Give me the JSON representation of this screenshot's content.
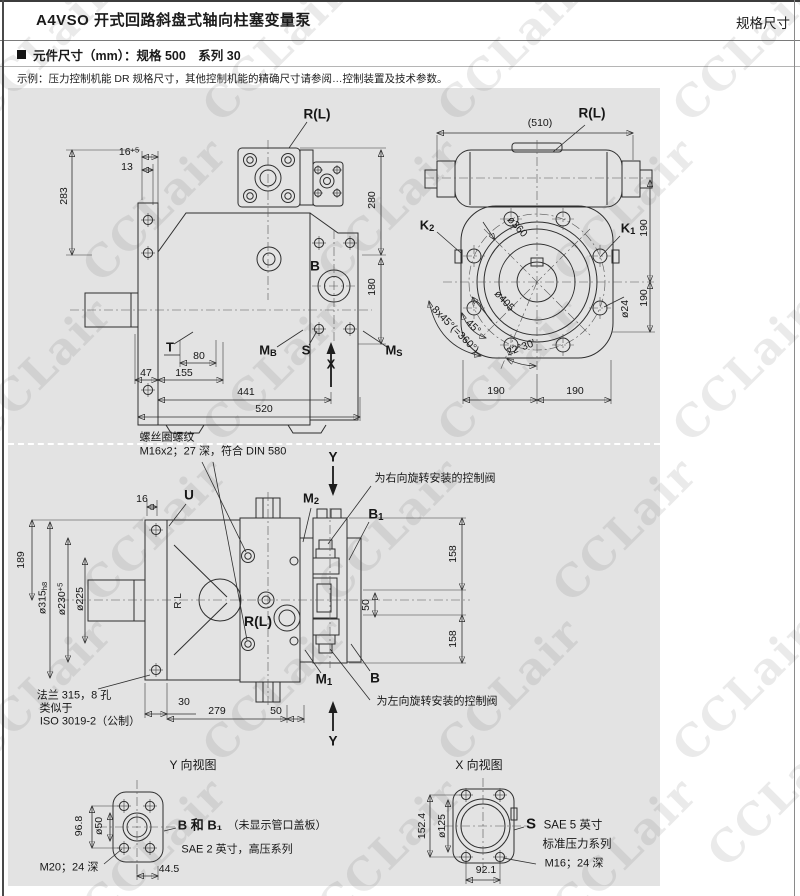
{
  "header": {
    "title": "A4VSO 开式回路斜盘式轴向柱塞变量泵",
    "page_label": "规格尺寸"
  },
  "section": {
    "bullet_title": "元件尺寸（mm）：规格 500　系列 30",
    "note": "示例：压力控制机能 DR 规格尺寸，其他控制机能的精确尺寸请参阅…控制装置及技术参数。"
  },
  "watermark": {
    "text": "CCLair",
    "tiles": [
      [
        40,
        50
      ],
      [
        275,
        50
      ],
      [
        510,
        50
      ],
      [
        745,
        50
      ],
      [
        155,
        210
      ],
      [
        390,
        210
      ],
      [
        625,
        210
      ],
      [
        40,
        370
      ],
      [
        275,
        370
      ],
      [
        510,
        370
      ],
      [
        745,
        370
      ],
      [
        155,
        530
      ],
      [
        390,
        530
      ],
      [
        625,
        530
      ],
      [
        40,
        690
      ],
      [
        275,
        690
      ],
      [
        510,
        690
      ],
      [
        745,
        690
      ],
      [
        155,
        850
      ],
      [
        390,
        850
      ],
      [
        625,
        850
      ],
      [
        780,
        795
      ]
    ]
  },
  "drawings": [
    {
      "name": "side-view-top",
      "labels": [
        {
          "n": "d1-dim-283",
          "t": "283",
          "x": 64,
          "y": 196,
          "r": -90
        },
        {
          "n": "d1-dim-16plus5",
          "t": "16",
          "sup": "+5",
          "x": 129,
          "y": 152
        },
        {
          "n": "d1-dim-13",
          "t": "13",
          "x": 127,
          "y": 167
        },
        {
          "n": "d1-port-RL",
          "t": "R(L)",
          "x": 317,
          "y": 114,
          "b": 1,
          "s": 13.5
        },
        {
          "n": "d1-dim-280",
          "t": "280",
          "x": 372,
          "y": 200,
          "r": -90
        },
        {
          "n": "d1-port-B",
          "t": "B",
          "x": 315,
          "y": 266,
          "b": 1,
          "s": 13.5
        },
        {
          "n": "d1-dim-180",
          "t": "180",
          "x": 372,
          "y": 287,
          "r": -90
        },
        {
          "n": "d1-port-T",
          "t": "T",
          "x": 170,
          "y": 347,
          "b": 1,
          "s": 13
        },
        {
          "n": "d1-dim-80",
          "t": "80",
          "x": 199,
          "y": 356
        },
        {
          "n": "d1-dim-47",
          "t": "47",
          "x": 146,
          "y": 373
        },
        {
          "n": "d1-dim-155",
          "t": "155",
          "x": 184,
          "y": 373
        },
        {
          "n": "d1-port-MB",
          "t": "M",
          "sub": "B",
          "x": 268,
          "y": 351,
          "b": 1,
          "s": 13
        },
        {
          "n": "d1-port-S",
          "t": "S",
          "x": 306,
          "y": 350,
          "b": 1,
          "s": 13
        },
        {
          "n": "d1-axis-X",
          "t": "X",
          "x": 331,
          "y": 364,
          "b": 1,
          "s": 13
        },
        {
          "n": "d1-port-MS",
          "t": "M",
          "sub": "S",
          "x": 394,
          "y": 351,
          "b": 1,
          "s": 13
        },
        {
          "n": "d1-dim-441",
          "t": "441",
          "x": 246,
          "y": 392
        },
        {
          "n": "d1-dim-520",
          "t": "520",
          "x": 264,
          "y": 409
        }
      ]
    },
    {
      "name": "flange-view-top-right",
      "labels": [
        {
          "n": "d2-dim-510",
          "t": "(510)",
          "x": 540,
          "y": 123
        },
        {
          "n": "d2-port-RL",
          "t": "R(L)",
          "x": 592,
          "y": 113,
          "b": 1,
          "s": 13.5
        },
        {
          "n": "d2-port-K2",
          "t": "K",
          "sub": "2",
          "x": 427,
          "y": 226,
          "b": 1,
          "s": 13
        },
        {
          "n": "d2-port-K1",
          "t": "K",
          "sub": "1",
          "x": 628,
          "y": 229,
          "b": 1,
          "s": 13
        },
        {
          "n": "d2-dim-190-upper",
          "t": "190",
          "x": 644,
          "y": 228,
          "r": -90
        },
        {
          "n": "d2-dim-dia360",
          "t": "ø360",
          "x": 517,
          "y": 227,
          "r": 47
        },
        {
          "n": "d2-dim-dia405",
          "t": "ø405",
          "x": 504,
          "y": 301,
          "r": 47
        },
        {
          "n": "d2-dim-dia24",
          "t": "ø24",
          "x": 625,
          "y": 309,
          "r": -90
        },
        {
          "n": "d2-dim-190-lower",
          "t": "190",
          "x": 644,
          "y": 298,
          "r": -90
        },
        {
          "n": "d2-dim-8x45",
          "t": "8x45°(=360°)",
          "x": 455,
          "y": 330,
          "r": 45
        },
        {
          "n": "d2-dim-45",
          "t": "45°",
          "x": 473,
          "y": 327,
          "r": 45
        },
        {
          "n": "d2-dim-2230",
          "t": "22°30'",
          "x": 521,
          "y": 348,
          "r": -20
        },
        {
          "n": "d2-dim-190-bl",
          "t": "190",
          "x": 496,
          "y": 391
        },
        {
          "n": "d2-dim-190-br",
          "t": "190",
          "x": 575,
          "y": 391
        }
      ]
    },
    {
      "name": "side-view-middle",
      "labels": [
        {
          "n": "d3-note-thread-line1",
          "t": "螺丝圈螺纹",
          "x": 167,
          "y": 438,
          "s": 11
        },
        {
          "n": "d3-note-thread-line2",
          "t": "M16x2；27 深，符合 DIN 580",
          "x": 213,
          "y": 452,
          "s": 11
        },
        {
          "n": "d3-axis-Y-top",
          "t": "Y",
          "x": 333,
          "y": 457,
          "b": 1,
          "s": 13.5
        },
        {
          "n": "d3-note-cw-valve",
          "t": "为右向旋转安装的控制阀",
          "x": 435,
          "y": 479,
          "s": 11
        },
        {
          "n": "d3-dim-16",
          "t": "16",
          "x": 142,
          "y": 499
        },
        {
          "n": "d3-port-U",
          "t": "U",
          "x": 189,
          "y": 495,
          "b": 1,
          "s": 13.5
        },
        {
          "n": "d3-port-M2",
          "t": "M",
          "sub": "2",
          "x": 311,
          "y": 499,
          "b": 1,
          "s": 13
        },
        {
          "n": "d3-port-B1",
          "t": "B",
          "sub": "1",
          "x": 376,
          "y": 515,
          "b": 1,
          "s": 13.5
        },
        {
          "n": "d3-dim-189",
          "t": "189",
          "x": 21,
          "y": 560,
          "r": -90
        },
        {
          "n": "d3-dim-dia315",
          "t": "ø315",
          "sub": "h8",
          "x": 43,
          "y": 598,
          "r": -90
        },
        {
          "n": "d3-dim-dia230",
          "t": "ø230",
          "sup": "+5",
          "x": 62,
          "y": 599,
          "r": -90
        },
        {
          "n": "d3-dim-dia225",
          "t": "ø225",
          "x": 80,
          "y": 599,
          "r": -90
        },
        {
          "n": "d3-mark-LR",
          "t": "R L",
          "x": 179,
          "y": 601,
          "r": -90,
          "s": 10
        },
        {
          "n": "d3-port-RL",
          "t": "R(L)",
          "x": 258,
          "y": 621,
          "b": 1,
          "s": 14
        },
        {
          "n": "d3-dim-158-top",
          "t": "158",
          "x": 453,
          "y": 554,
          "r": -90
        },
        {
          "n": "d3-dim-50-mid",
          "t": "50",
          "x": 366,
          "y": 605,
          "r": -90
        },
        {
          "n": "d3-dim-158-bot",
          "t": "158",
          "x": 453,
          "y": 639,
          "r": -90
        },
        {
          "n": "d3-port-M1",
          "t": "M",
          "sub": "1",
          "x": 324,
          "y": 680,
          "b": 1,
          "s": 13.5
        },
        {
          "n": "d3-port-B",
          "t": "B",
          "x": 375,
          "y": 678,
          "b": 1,
          "s": 13.5
        },
        {
          "n": "d3-note-ccw-valve",
          "t": "为左向旋转安装的控制阀",
          "x": 437,
          "y": 702,
          "s": 11
        },
        {
          "n": "d3-note-flange-line1",
          "t": "法兰 315，8 孔",
          "x": 74,
          "y": 696,
          "s": 11
        },
        {
          "n": "d3-note-flange-line2",
          "t": "类似于",
          "x": 56,
          "y": 709,
          "s": 11
        },
        {
          "n": "d3-note-flange-line3",
          "t": "ISO 3019-2（公制）",
          "x": 90,
          "y": 722,
          "s": 11
        },
        {
          "n": "d3-dim-30",
          "t": "30",
          "x": 184,
          "y": 702
        },
        {
          "n": "d3-dim-279",
          "t": "279",
          "x": 217,
          "y": 711
        },
        {
          "n": "d3-dim-50-bot",
          "t": "50",
          "x": 276,
          "y": 711
        },
        {
          "n": "d3-axis-Y-bot",
          "t": "Y",
          "x": 333,
          "y": 741,
          "b": 1,
          "s": 13.5
        }
      ]
    },
    {
      "name": "view-Y",
      "labels": [
        {
          "n": "d4-title",
          "t": "Y 向视图",
          "x": 193,
          "y": 765,
          "s": 12
        },
        {
          "n": "d4-dim-968",
          "t": "96.8",
          "x": 79,
          "y": 826,
          "r": -90
        },
        {
          "n": "d4-dim-dia50",
          "t": "ø50",
          "x": 99,
          "y": 826,
          "r": -90
        },
        {
          "n": "d4-note-ports",
          "t": "B 和 B₁",
          "x": 200,
          "y": 825,
          "b": 1,
          "s": 13
        },
        {
          "n": "d4-note-cover",
          "t": "（未显示管口盖板）",
          "x": 277,
          "y": 826,
          "s": 11
        },
        {
          "n": "d4-note-sae",
          "t": "SAE 2 英寸，高压系列",
          "x": 237,
          "y": 850,
          "s": 11
        },
        {
          "n": "d4-note-m20",
          "t": "M20；24 深",
          "x": 69,
          "y": 868,
          "s": 11
        },
        {
          "n": "d4-dim-445",
          "t": "44.5",
          "x": 169,
          "y": 869
        }
      ]
    },
    {
      "name": "view-X",
      "labels": [
        {
          "n": "d5-title",
          "t": "X 向视图",
          "x": 479,
          "y": 765,
          "s": 12
        },
        {
          "n": "d5-dim-1524",
          "t": "152.4",
          "x": 422,
          "y": 826,
          "r": -90
        },
        {
          "n": "d5-dim-dia125",
          "t": "ø125",
          "x": 442,
          "y": 826,
          "r": -90
        },
        {
          "n": "d5-port-S",
          "t": "S",
          "x": 531,
          "y": 824,
          "b": 1,
          "s": 15
        },
        {
          "n": "d5-note-sae",
          "t": "SAE 5 英寸",
          "x": 573,
          "y": 826,
          "s": 11.5
        },
        {
          "n": "d5-note-std",
          "t": "标准压力系列",
          "x": 577,
          "y": 845,
          "s": 11.5
        },
        {
          "n": "d5-note-m16",
          "t": "M16；24 深",
          "x": 574,
          "y": 864,
          "s": 11
        },
        {
          "n": "d5-dim-921",
          "t": "92.1",
          "x": 486,
          "y": 870
        }
      ]
    }
  ]
}
